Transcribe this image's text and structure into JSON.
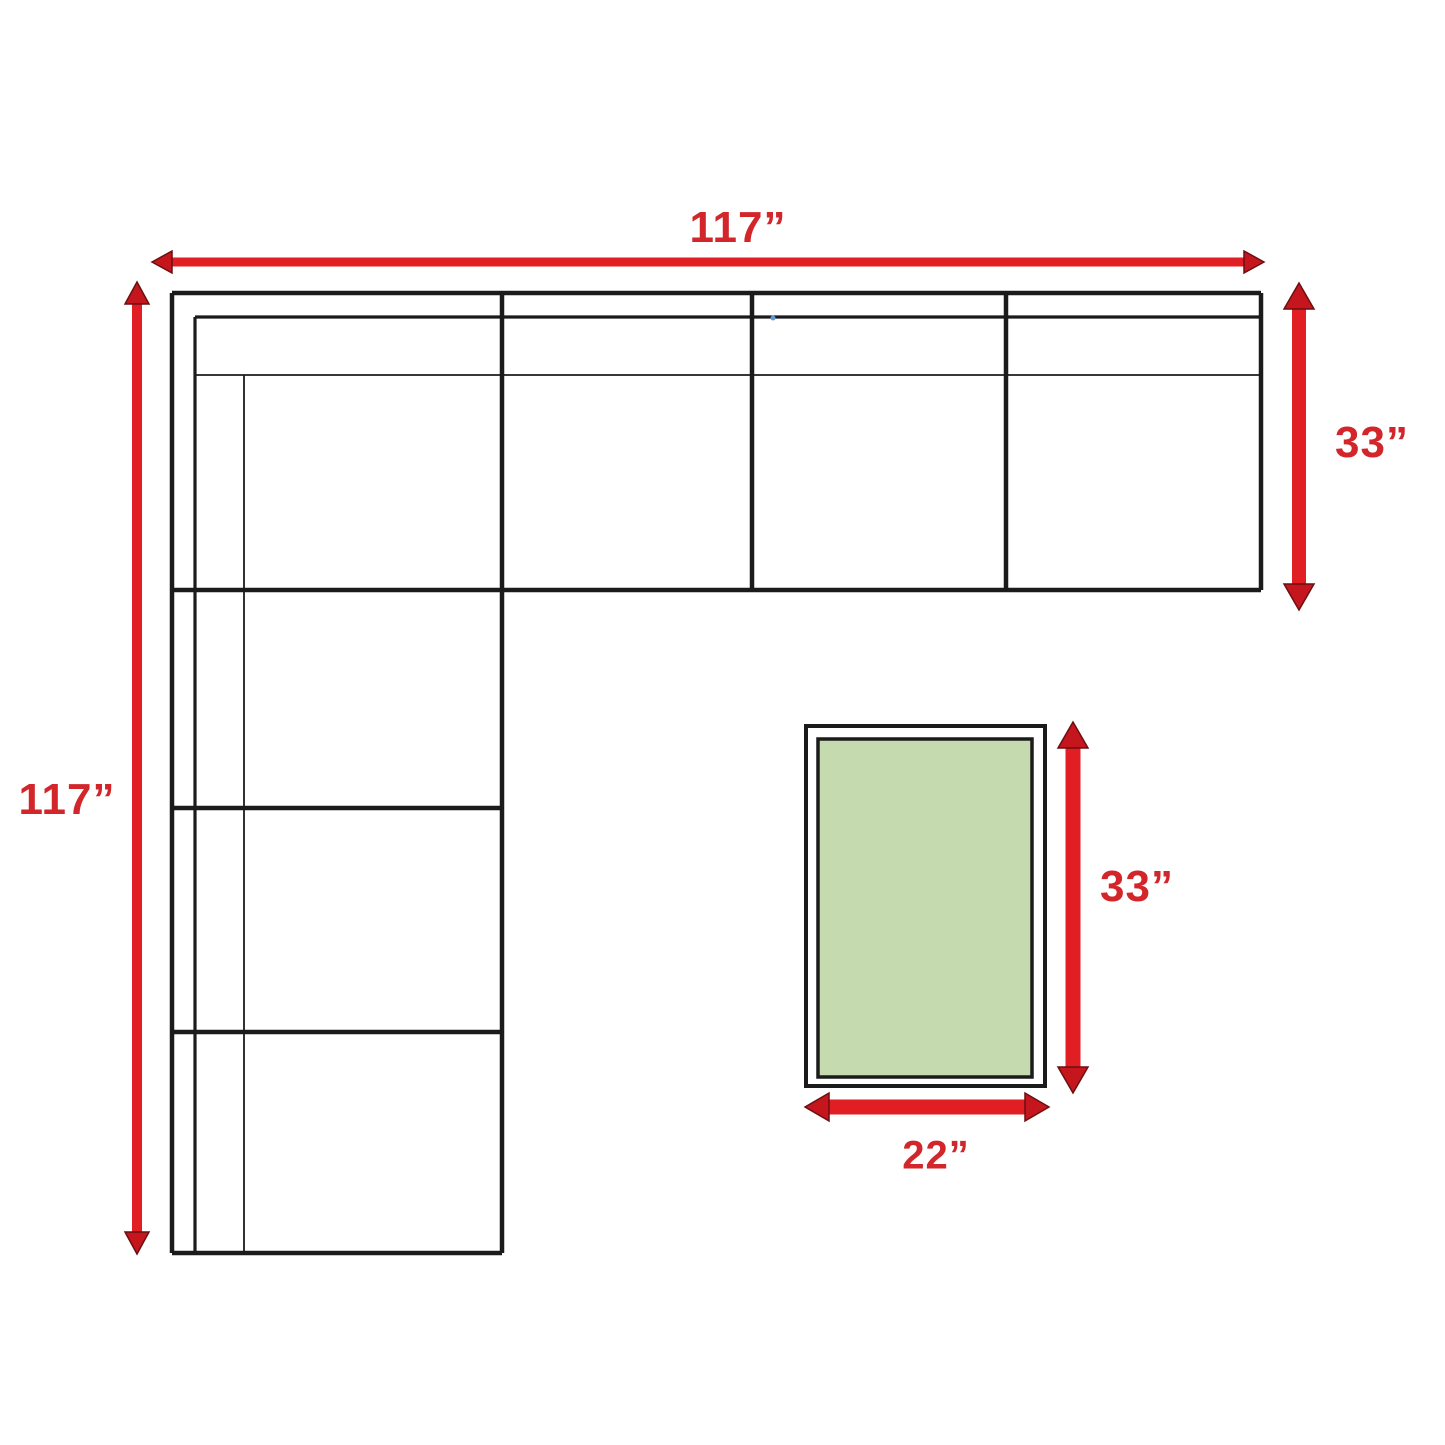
{
  "diagram": {
    "type": "furniture-dimension-diagram",
    "labels": {
      "sofa_width": "117”",
      "sofa_height": "117”",
      "sofa_depth": "33”",
      "ottoman_length": "33”",
      "ottoman_width": "22”"
    },
    "shapes": {
      "sectional_sofa": "L-shaped sectional outline, 4 seats across top strip, 3 seats down left strip, left arm",
      "ottoman": "rectangle with green cushion inset"
    },
    "colors": {
      "outline_black": "#1B1B1B",
      "dimension_arrow_red": "#E01E24",
      "arrow_head_red": "#C4161C",
      "label_red": "#D2262B",
      "ottoman_green": "#C6DAB0",
      "background": "#FFFFFF",
      "artifact_dot_blue": "#5B9BD5"
    }
  }
}
